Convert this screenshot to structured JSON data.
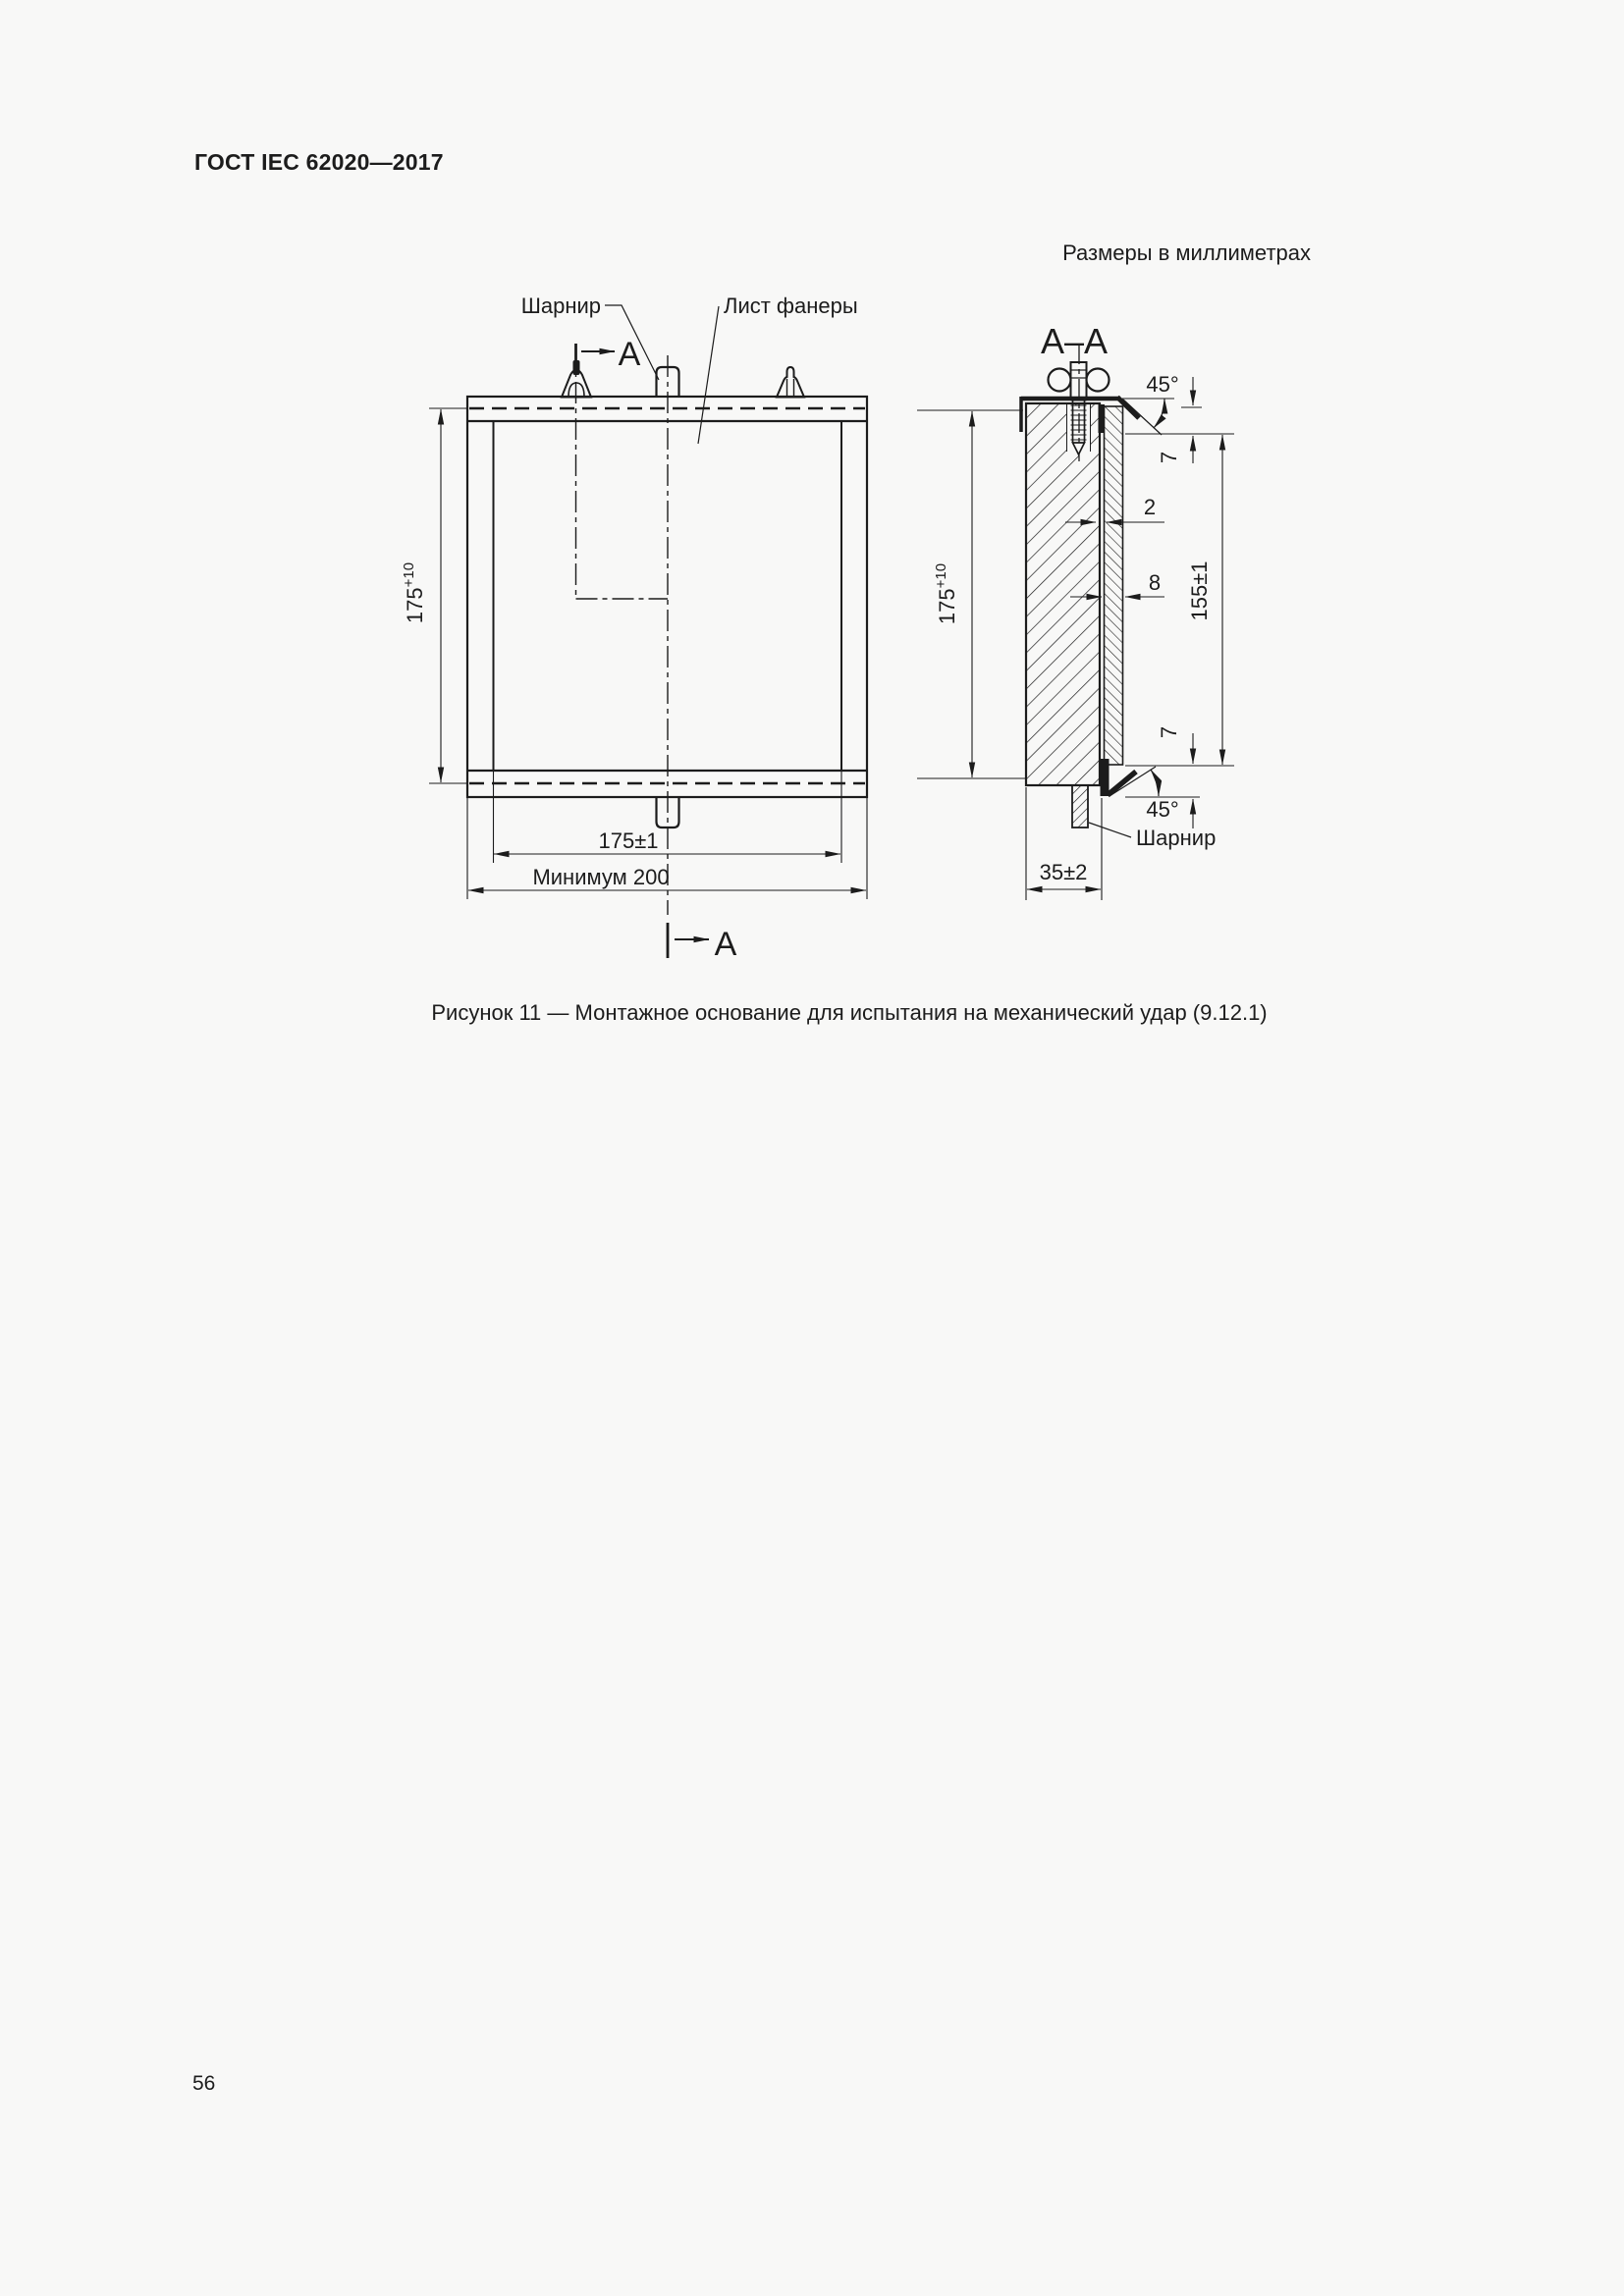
{
  "page": {
    "header": "ГОСТ IEC 62020—2017",
    "units_note": "Размеры в миллиметрах",
    "caption": "Рисунок 11 — Монтажное основание для испытания на механический удар (9.12.1)",
    "page_number": "56"
  },
  "front": {
    "hinge_label": "Шарнир",
    "plywood_label": "Лист фанеры",
    "section_arrow": "A",
    "height_value": "175",
    "height_tol": "+10",
    "sheet_width": "175±1",
    "min_width": "Минимум 200"
  },
  "section": {
    "title": "A–A",
    "height_value": "175",
    "height_tol": "+10",
    "sheet_height": "155±1",
    "gap": "2",
    "sheet_thickness": "8",
    "offset_top": "7",
    "offset_bottom": "7",
    "base_width": "35±2",
    "angle_top": "45°",
    "angle_bottom": "45°",
    "hinge_label": "Шарнир"
  },
  "colors": {
    "ink": "#1c1c1c",
    "paper": "#f8f8f7"
  }
}
